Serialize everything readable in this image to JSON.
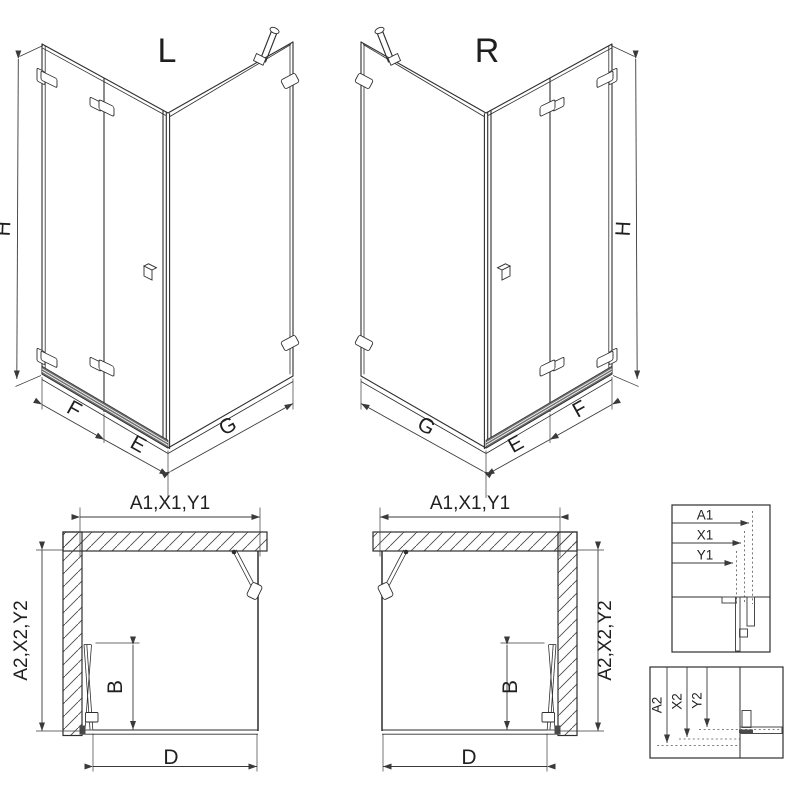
{
  "drawing": {
    "colors": {
      "background": "#ffffff",
      "line": "#2e2e2e",
      "dimension": "#3a3a3a",
      "rail": "#6f6f6f",
      "hatch": "#4a4a4a"
    },
    "iso_left": {
      "label": "L",
      "height": "H",
      "fixed_panel": "F",
      "door_panel": "E",
      "side_panel": "G"
    },
    "iso_right": {
      "label": "R",
      "height": "H",
      "fixed_panel": "F",
      "door_panel": "E",
      "side_panel": "G"
    },
    "plan_left": {
      "width": "A1,X1,Y1",
      "depth": "A2,X2,Y2",
      "door": "B",
      "opening": "D"
    },
    "plan_right": {
      "width": "A1,X1,Y1",
      "depth": "A2,X2,Y2",
      "door": "B",
      "opening": "D"
    },
    "detail_width": {
      "labels": [
        "A1",
        "X1",
        "Y1"
      ]
    },
    "detail_height": {
      "labels": [
        "A2",
        "X2",
        "Y2"
      ]
    }
  }
}
